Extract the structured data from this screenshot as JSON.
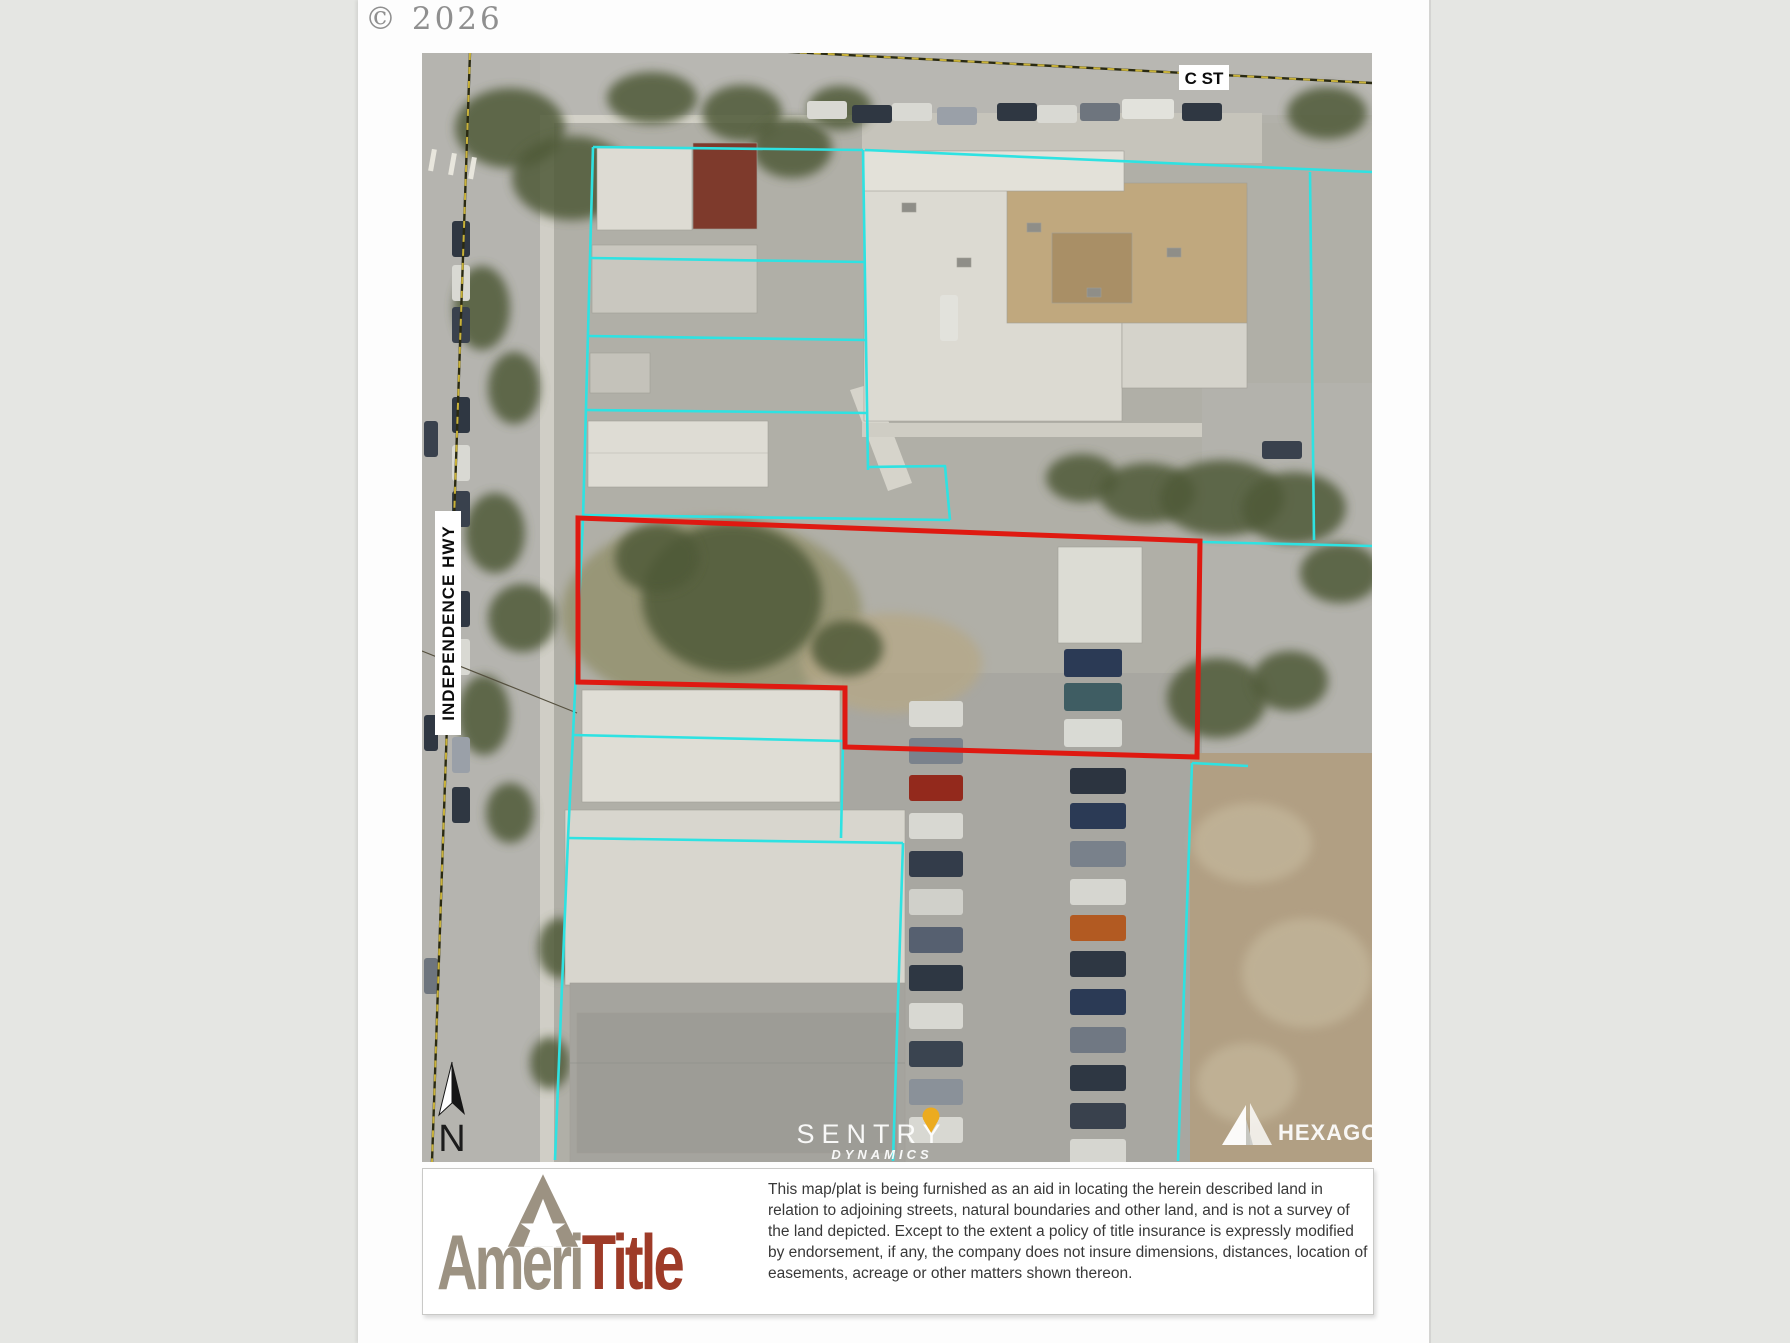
{
  "page": {
    "copyright": "© 2026"
  },
  "map": {
    "street_labels": {
      "c_st": "C ST",
      "independence_hwy": "INDEPENDENCE HWY"
    },
    "north_label": "N",
    "watermark": {
      "line1": "SENTRY",
      "line2": "DYNAMICS"
    },
    "provider": "HEXAGON"
  },
  "footer": {
    "logo": {
      "part1": "Ameri",
      "part2": "Title"
    },
    "disclaimer": "This map/plat is being furnished as an aid in locating the herein described land in relation to adjoining streets, natural boundaries and other land, and is not a survey of the land depicted. Except to the extent a policy of title insurance is expressly modified by endorsement, if any, the company does not insure dimensions, distances, location of easements, acreage or other matters shown thereon."
  },
  "theme": {
    "cyan": "#2ee2e2",
    "red": "#df1911",
    "dash": "#c9b23a",
    "taupe": "#9c9282",
    "brick": "#9e3b28",
    "pin": "#ecab1f"
  }
}
